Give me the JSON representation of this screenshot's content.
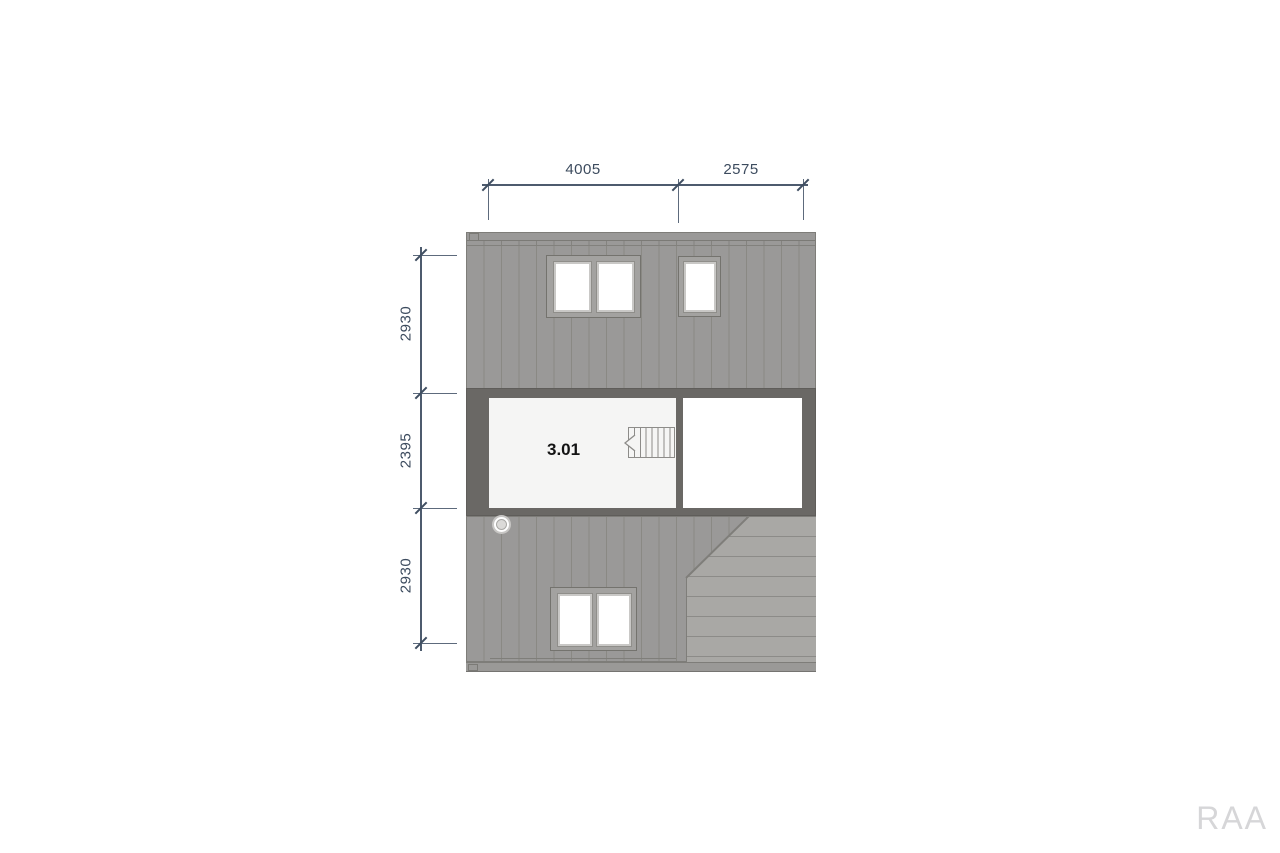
{
  "plan": {
    "room": {
      "label": "3.01"
    },
    "dimensions": {
      "top": [
        {
          "label": "4005"
        },
        {
          "label": "2575"
        }
      ],
      "left": [
        {
          "label": "2930"
        },
        {
          "label": "2395"
        },
        {
          "label": "2930"
        }
      ]
    },
    "icons": {
      "stair_direction": "stairs-arrow-left",
      "roof_penetration": "vent-circle"
    },
    "colors": {
      "roof_gray": "#9a9998",
      "deck_gray": "#a9a8a5",
      "wall_dark": "#6a6865",
      "room_light": "#f5f5f4",
      "room_white": "#ffffff",
      "dimension_blue": "#3c4b5e",
      "watermark_gray": "#d6d6d8"
    }
  },
  "watermark": {
    "text": "RAA"
  }
}
